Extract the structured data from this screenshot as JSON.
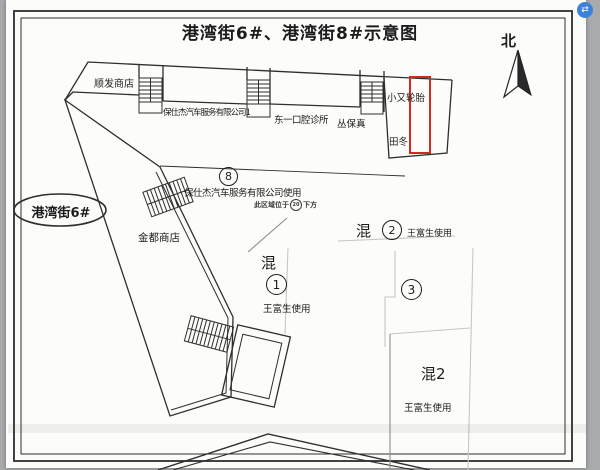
{
  "title": "港湾街6#、港湾街8#示意图",
  "compass": {
    "label": "北"
  },
  "street": {
    "label": "港湾街6#"
  },
  "buildings": {
    "shunfa": "顺发商店",
    "baoshijie_row": "保仕杰汽车服务有限公司1",
    "dental": "东一口腔诊所",
    "cong": "丛保真",
    "tire": "小又轮胎",
    "tiandong": "田冬",
    "jindu": "金都商店"
  },
  "zone8": {
    "number": "8",
    "label": "保仕杰汽车服务有限公司使用",
    "note_prefix": "此区域位于",
    "note_number": "20",
    "note_suffix": "下方"
  },
  "zones": {
    "z1": {
      "kind": "混",
      "number": "1",
      "user": "王富生使用"
    },
    "z2": {
      "kind": "混",
      "number": "2",
      "user": "王富生使用"
    },
    "z3": {
      "number": "3"
    },
    "hun2": {
      "label": "混2",
      "user": "王富生使用"
    }
  },
  "overlay": {
    "browser_icon_glyph": "⇄"
  },
  "colors": {
    "highlight_red": "#cf2a1f",
    "line": "#2e2e2e",
    "faint": "#c6c6c6",
    "page_bg": "#fcfcfa",
    "outside_bg": "#a8aaac",
    "accent_blue": "#3c82dd",
    "ink": "#1c1c1c"
  }
}
